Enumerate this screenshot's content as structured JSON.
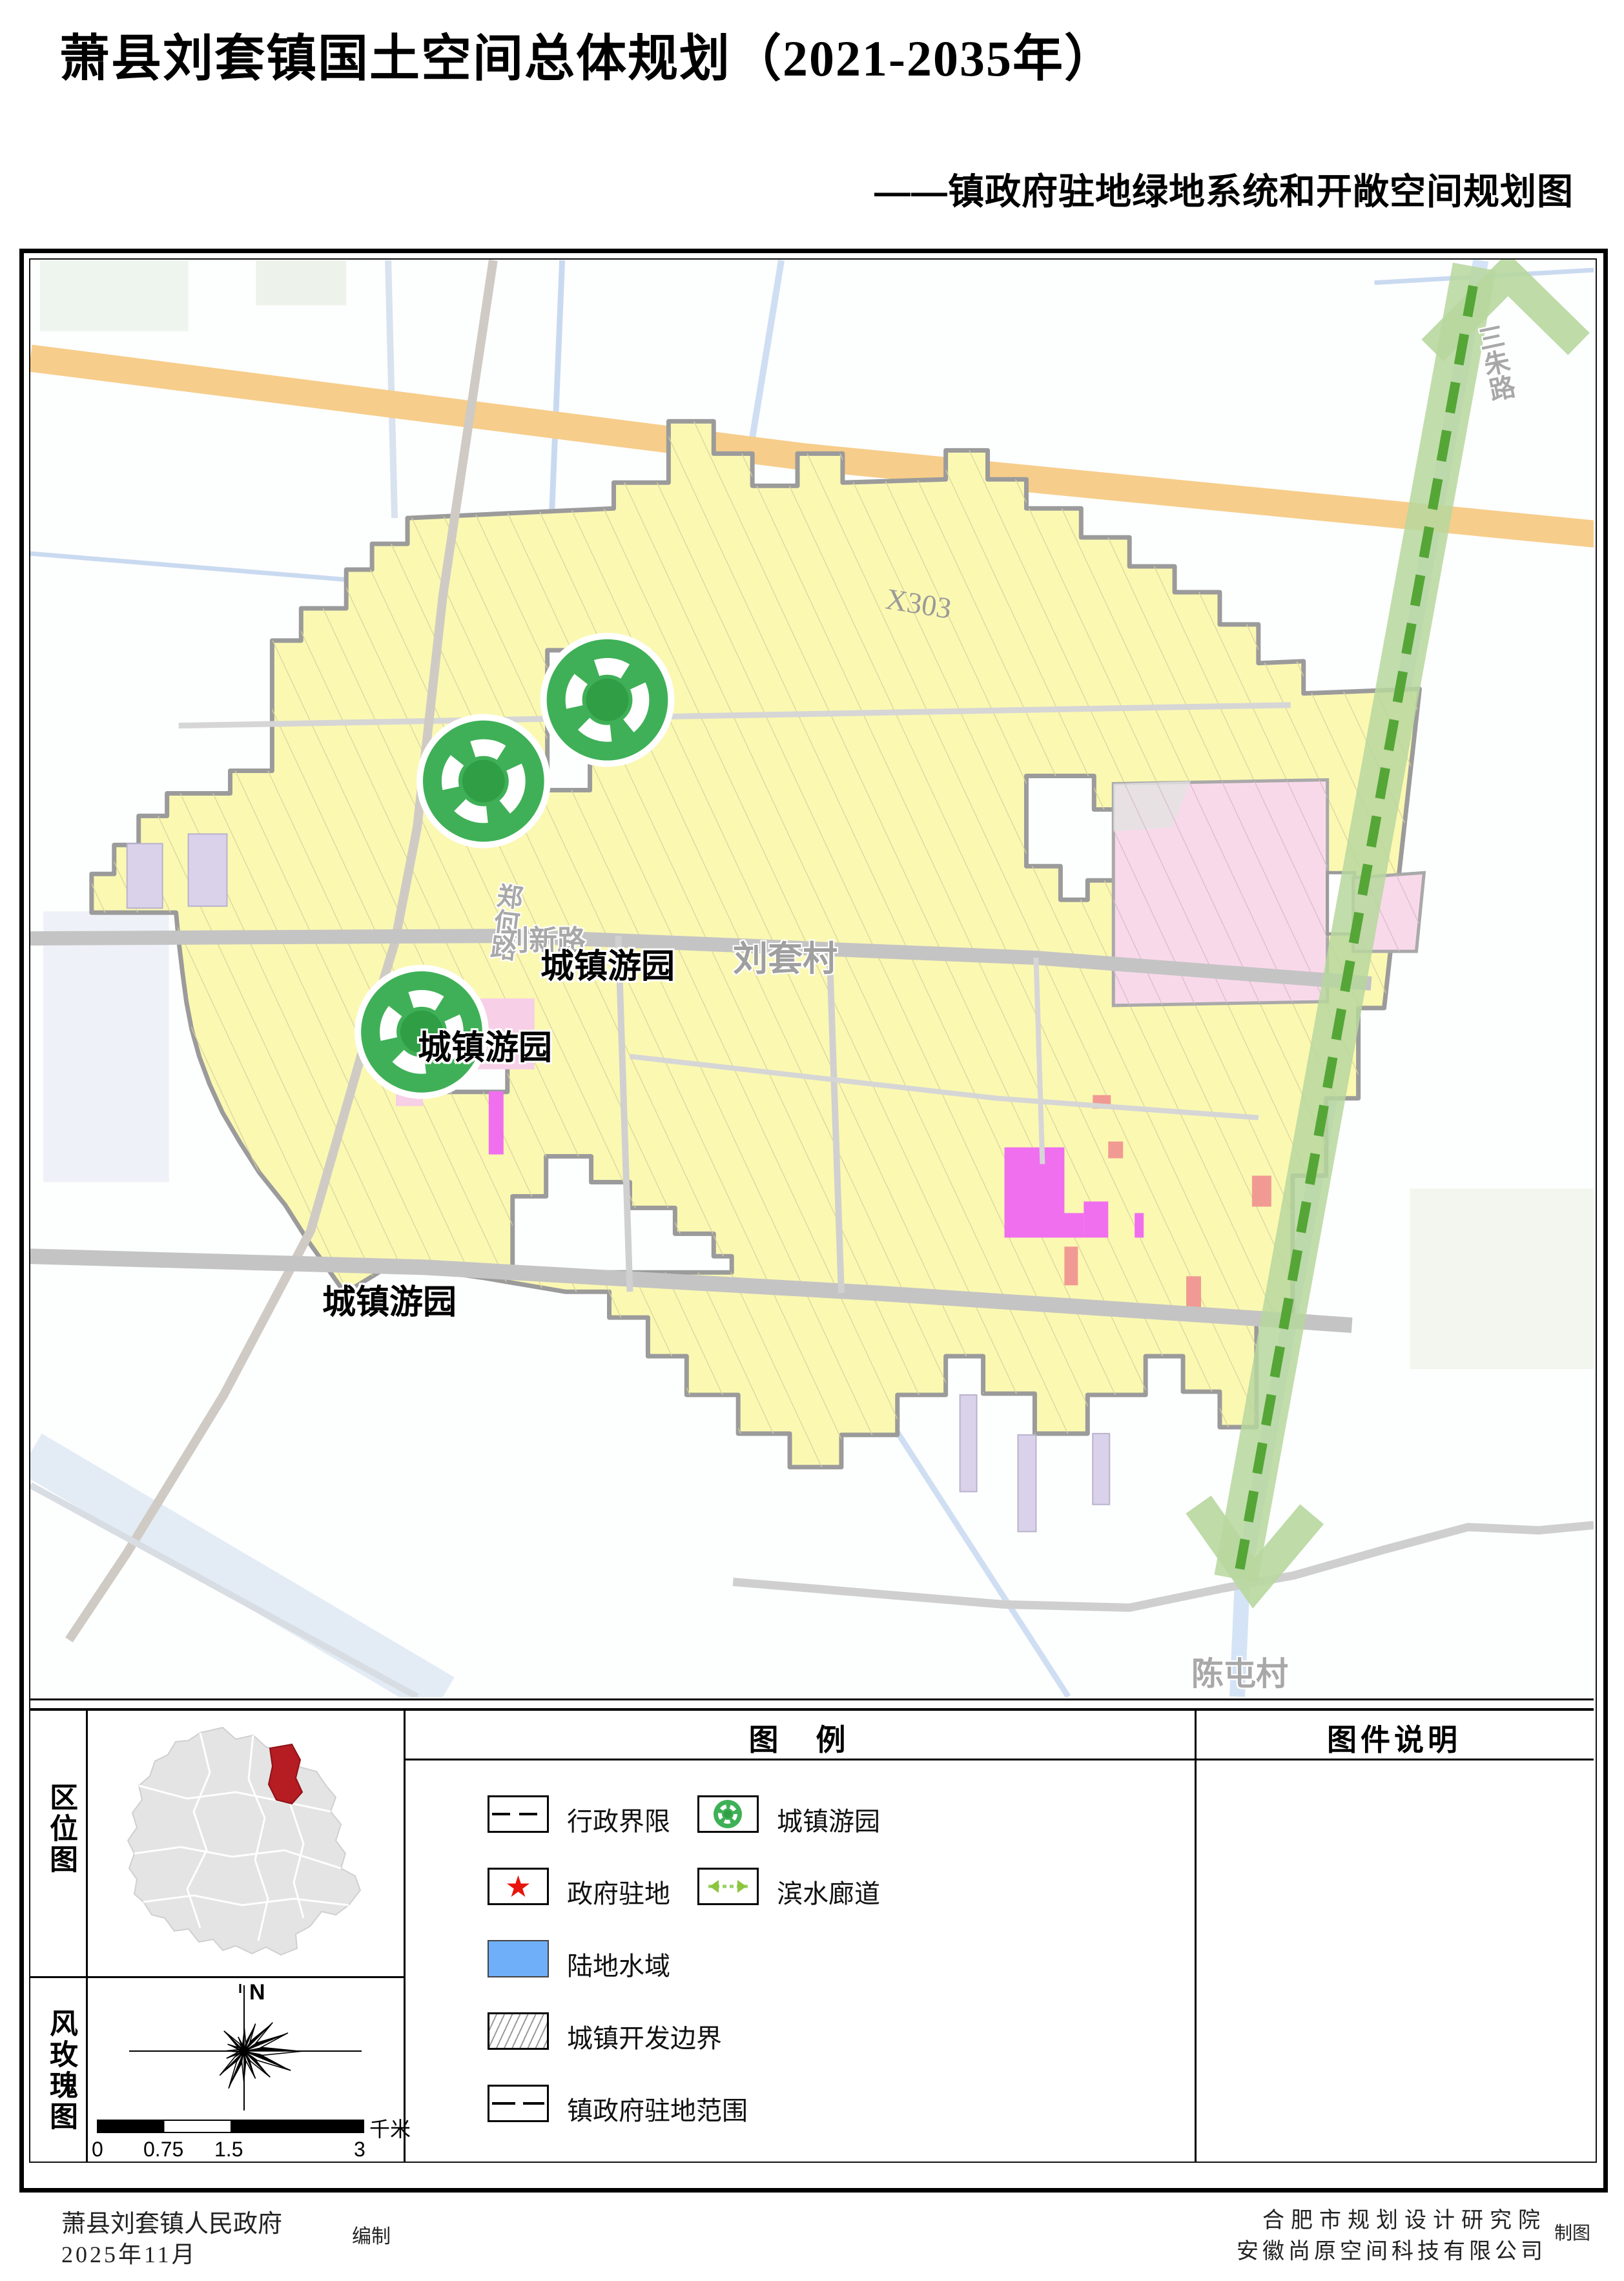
{
  "title": "萧县刘套镇国土空间总体规划（2021-2035年）",
  "subtitle": "——镇政府驻地绿地系统和开敞空间规划图",
  "map": {
    "road_labels": {
      "x303": "X303",
      "zhenghe_road": "郑何路",
      "liuxin_road": "刘新路",
      "sanzhu_road": "三朱路"
    },
    "place_labels": {
      "liutao_village": "刘套村",
      "chentun_village": "陈屯村"
    },
    "park_label": "城镇游园",
    "colors": {
      "development_boundary_fill": "#FBF8B2",
      "boundary_outline": "#9b9b9b",
      "x303_road": "#F6CD8A",
      "pink_zone": "#F8D9EA",
      "magenta_parcel": "#EF6FEF",
      "salmon_parcel": "#F19A93",
      "lavender_parcel": "#D9D2EA",
      "water": "#C9DAF0",
      "corridor_band": "#B7D79E",
      "corridor_dash": "#55A637",
      "park_green": "#3FB057"
    }
  },
  "panels": {
    "location": {
      "label": "区位图",
      "highlight_color": "#B51D22"
    },
    "windrose": {
      "label": "风玫瑰图",
      "north": "N",
      "scale_ticks": [
        "0",
        "0.75",
        "1.5",
        "3"
      ],
      "scale_unit": "千米",
      "petals": [
        42,
        50,
        68,
        80,
        100,
        85,
        62,
        50,
        55,
        68,
        58,
        32,
        34,
        30,
        48,
        26
      ]
    },
    "legend": {
      "title": "图　例",
      "items": [
        {
          "label": "行政界限"
        },
        {
          "label": "政府驻地"
        },
        {
          "label": "陆地水域"
        },
        {
          "label": "城镇开发边界"
        },
        {
          "label": "镇政府驻地范围"
        },
        {
          "label": "城镇游园"
        },
        {
          "label": "滨水廊道"
        }
      ],
      "star_color": "#E8150C",
      "water_color": "#6FAEF8"
    },
    "notes": {
      "title": "图件说明"
    }
  },
  "footer": {
    "left_line1": "萧县刘套镇人民政府",
    "left_role": "编制",
    "left_line2": "2025年11月",
    "right_line1": "合肥市规划设计研究院",
    "right_line2": "安徽尚原空间科技有限公司",
    "right_role": "制图"
  }
}
